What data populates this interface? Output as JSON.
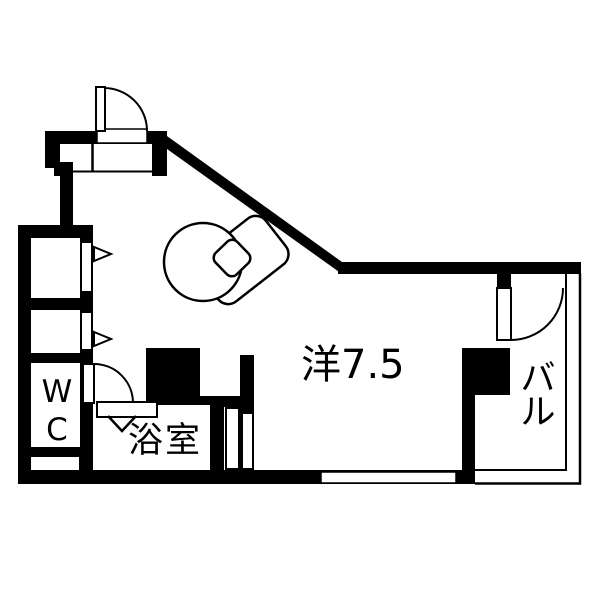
{
  "meta": {
    "type": "japanese-apartment-floor-plan",
    "colors": {
      "wall": "#000000",
      "floor": "#ffffff"
    }
  },
  "labels": {
    "main_room": "洋7.5",
    "balcony": "バル",
    "toilet": "WC",
    "bathroom": "浴室"
  }
}
